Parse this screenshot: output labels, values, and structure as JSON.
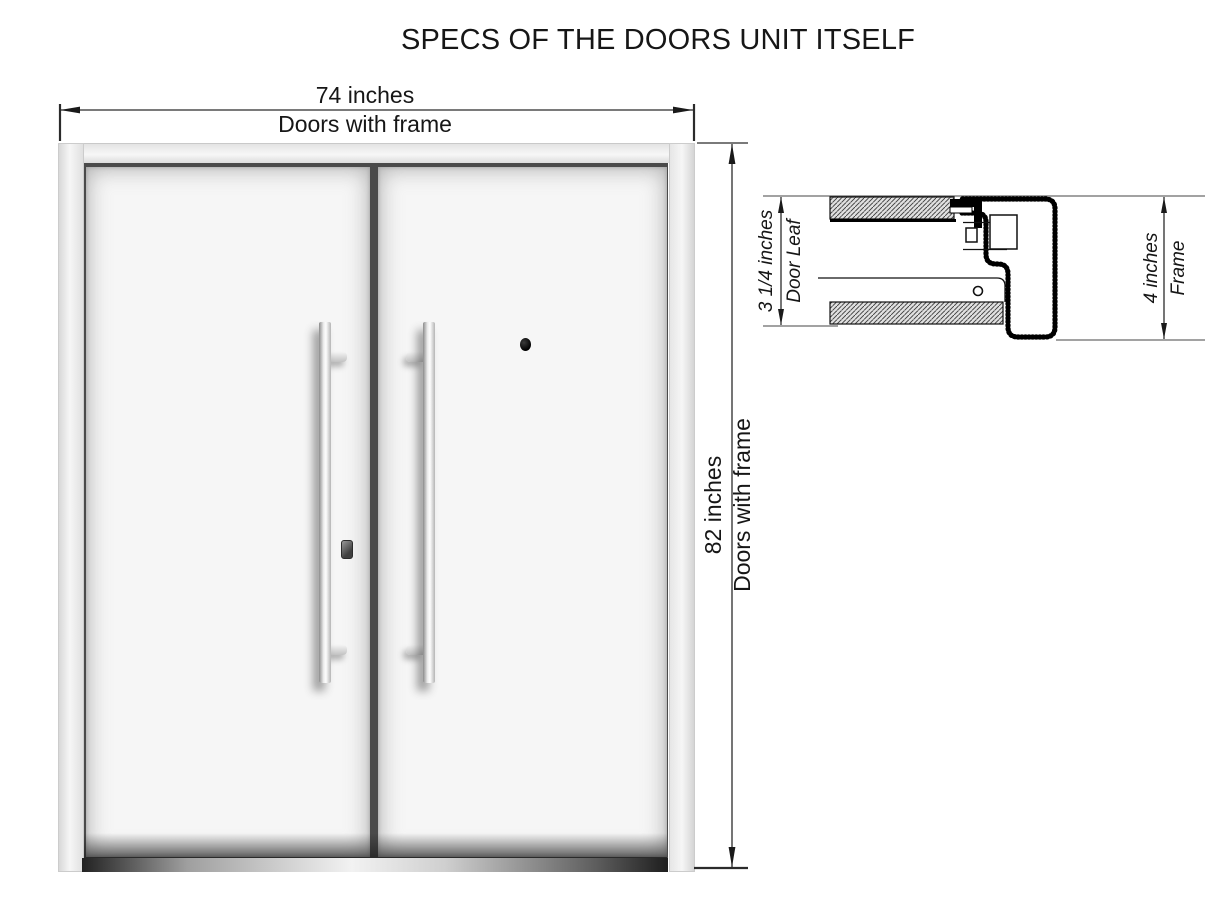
{
  "title": "SPECS OF THE DOORS UNIT ITSELF",
  "front_view": {
    "width_dimension": {
      "value": "74 inches",
      "label": "Doors with frame"
    },
    "height_dimension": {
      "value": "82 inches",
      "label": "Doors with frame"
    }
  },
  "section_view": {
    "door_leaf_dimension": {
      "value": "3 1/4 inches",
      "label": "Door Leaf"
    },
    "frame_dimension": {
      "value": "4 inches",
      "label": "Frame"
    }
  },
  "colors": {
    "drawing_line": "#1a1a1a",
    "frame_fill": "#e9e9e9",
    "door_fill": "#f6f6f6",
    "threshold_dark": "#222222"
  }
}
